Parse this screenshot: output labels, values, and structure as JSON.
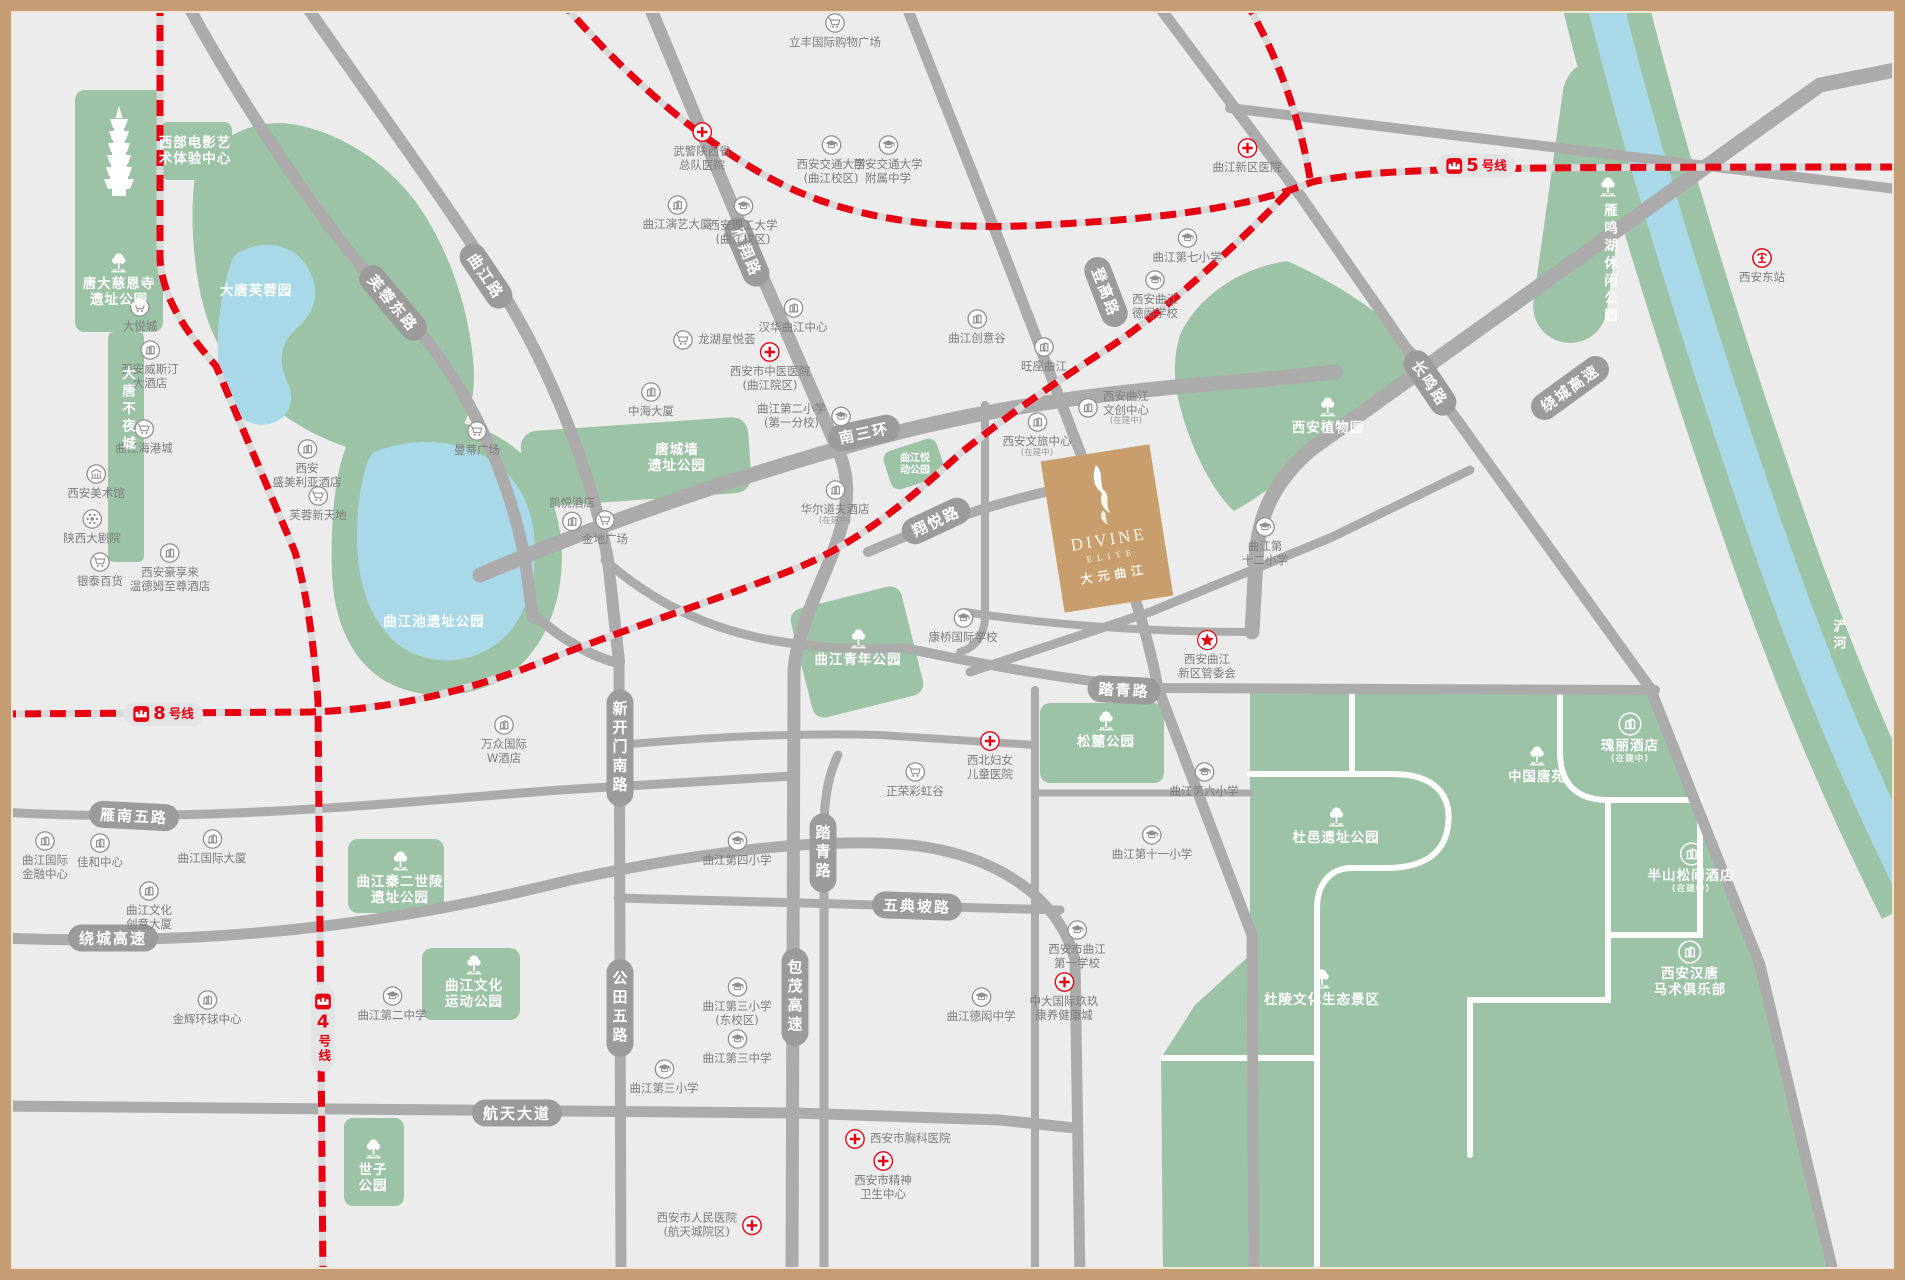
{
  "colors": {
    "metro_red": "#e60012",
    "road_gray": "#ababab",
    "road_pill": "#9b9b9b",
    "park_green": "#9dc3a6",
    "water_blue": "#a9d8e8",
    "brand_tan": "#c89e6c",
    "frame_tan": "#c59d72",
    "bg": "#ececec"
  },
  "divine": {
    "en": "DIVINE",
    "sub": "ELITE",
    "cn": "大元曲江"
  },
  "metro_badges": [
    {
      "n": "8",
      "s": "号线",
      "x": 163,
      "y": 714
    },
    {
      "n": "5",
      "s": "号线",
      "x": 1476,
      "y": 166
    },
    {
      "n": "4",
      "s": "号线",
      "x": 323,
      "y": 1028,
      "vt": 1
    }
  ],
  "road_labels": [
    {
      "t": "芙蓉东路",
      "x": 393,
      "y": 303,
      "r": 50
    },
    {
      "t": "曲江路",
      "x": 486,
      "y": 276,
      "r": 56
    },
    {
      "t": "雁翔路",
      "x": 747,
      "y": 252,
      "r": 67
    },
    {
      "t": "登高路",
      "x": 1106,
      "y": 292,
      "r": 69
    },
    {
      "t": "长鸣路",
      "x": 1430,
      "y": 383,
      "r": 56
    },
    {
      "t": "南三环",
      "x": 864,
      "y": 433,
      "r": -12
    },
    {
      "t": "绕城高速",
      "x": 1570,
      "y": 388,
      "r": -36
    },
    {
      "t": "绕城高速",
      "x": 113,
      "y": 938,
      "r": 0
    },
    {
      "t": "雁南五路",
      "x": 134,
      "y": 816,
      "r": 3
    },
    {
      "t": "航天大道",
      "x": 517,
      "y": 1113,
      "r": 0
    },
    {
      "t": "五典坡路",
      "x": 917,
      "y": 906,
      "r": 2
    },
    {
      "t": "踏青路",
      "x": 1124,
      "y": 690,
      "r": 3
    },
    {
      "t": "踏青路",
      "x": 823,
      "y": 853,
      "vt": 1
    },
    {
      "t": "新开门南路",
      "x": 620,
      "y": 748,
      "vt": 1
    },
    {
      "t": "公田五路",
      "x": 620,
      "y": 1008,
      "vt": 1
    },
    {
      "t": "包茂高速",
      "x": 795,
      "y": 997,
      "vt": 1
    },
    {
      "t": "翔悦路",
      "x": 936,
      "y": 521,
      "r": -25
    },
    {
      "t": "浐河",
      "x": 1838,
      "y": 636,
      "vt": 1,
      "plain": 1
    }
  ],
  "pois": [
    {
      "i": "cart",
      "x": 140,
      "y": 307,
      "l": [
        "大悦城"
      ]
    },
    {
      "i": "bldg",
      "x": 150,
      "y": 350,
      "l": [
        "西安威斯汀",
        "大酒店"
      ]
    },
    {
      "i": "cart",
      "x": 144,
      "y": 429,
      "l": [
        "曲江海港城"
      ]
    },
    {
      "i": "cart",
      "x": 477,
      "y": 431,
      "l": [
        "曼蒂广场"
      ]
    },
    {
      "i": "museum",
      "x": 96,
      "y": 474,
      "l": [
        "西安美术馆"
      ]
    },
    {
      "i": "theater",
      "x": 92,
      "y": 519,
      "l": [
        "陕西大剧院"
      ]
    },
    {
      "i": "cart",
      "x": 100,
      "y": 562,
      "l": [
        "银泰百货"
      ]
    },
    {
      "i": "bldg",
      "x": 170,
      "y": 553,
      "l": [
        "西安豪享来",
        "温德姆至尊酒店"
      ]
    },
    {
      "i": "bldg",
      "x": 307,
      "y": 449,
      "l": [
        "西安",
        "盛美利亚酒店"
      ]
    },
    {
      "i": "cart",
      "x": 318,
      "y": 496,
      "l": [
        "芙蓉新天地"
      ]
    },
    {
      "i": "bldg",
      "x": 572,
      "y": 521,
      "l": [
        "凯悦酒店"
      ],
      "lay": "lt"
    },
    {
      "i": "cart",
      "x": 605,
      "y": 520,
      "l": [
        "金地广场"
      ]
    },
    {
      "i": "bldg",
      "x": 504,
      "y": 725,
      "l": [
        "万众国际",
        "W酒店"
      ]
    },
    {
      "i": "cart",
      "x": 835,
      "y": 23,
      "l": [
        "立丰国际购物广场"
      ]
    },
    {
      "i": "hosp",
      "x": 702,
      "y": 132,
      "l": [
        "武警陕西省",
        "总队医院"
      ]
    },
    {
      "i": "school",
      "x": 831,
      "y": 145,
      "l": [
        "西安交通大学",
        "(曲江校区)"
      ]
    },
    {
      "i": "school",
      "x": 888,
      "y": 145,
      "l": [
        "西安交通大学",
        "附属中学"
      ]
    },
    {
      "i": "bldg",
      "x": 677,
      "y": 205,
      "l": [
        "曲江演艺大厦"
      ]
    },
    {
      "i": "school",
      "x": 743,
      "y": 206,
      "l": [
        "西安理工大学",
        "(曲江校区)"
      ]
    },
    {
      "i": "bldg",
      "x": 793,
      "y": 308,
      "l": [
        "汉华曲江中心"
      ]
    },
    {
      "i": "cart",
      "x": 683,
      "y": 340,
      "l": [
        "龙湖星悦荟"
      ],
      "lay": "hr"
    },
    {
      "i": "hosp",
      "x": 770,
      "y": 352,
      "l": [
        "西安市中医医院",
        "(曲江院区)"
      ]
    },
    {
      "i": "bldg",
      "x": 651,
      "y": 392,
      "l": [
        "中海大厦"
      ]
    },
    {
      "i": "school",
      "x": 841,
      "y": 416,
      "l": [
        "曲江第二小学",
        "(第一分校)"
      ],
      "lay": "hl"
    },
    {
      "i": "bldg",
      "x": 977,
      "y": 319,
      "l": [
        "曲江创意谷"
      ]
    },
    {
      "i": "bldg",
      "x": 1044,
      "y": 347,
      "l": [
        "旺座曲江"
      ]
    },
    {
      "i": "hosp",
      "x": 1247,
      "y": 148,
      "l": [
        "曲江新区医院"
      ]
    },
    {
      "i": "school",
      "x": 1187,
      "y": 238,
      "l": [
        "曲江第七小学"
      ]
    },
    {
      "i": "school",
      "x": 1155,
      "y": 280,
      "l": [
        "西安曲江",
        "德闳学校"
      ]
    },
    {
      "i": "bldg",
      "x": 1088,
      "y": 408,
      "l": [
        "西安曲江",
        "文创中心"
      ],
      "s": "(在建中)",
      "lay": "hr"
    },
    {
      "i": "bldg",
      "x": 1037,
      "y": 422,
      "l": [
        "西安文旅中心"
      ],
      "s": "(在建中)"
    },
    {
      "i": "bldg",
      "x": 835,
      "y": 490,
      "l": [
        "华尔道夫酒店"
      ],
      "s": "(在建中)"
    },
    {
      "i": "school",
      "x": 963,
      "y": 618,
      "l": [
        "康桥国际学校"
      ]
    },
    {
      "i": "star",
      "x": 1207,
      "y": 640,
      "l": [
        "西安曲江",
        "新区管委会"
      ]
    },
    {
      "i": "school",
      "x": 1265,
      "y": 527,
      "l": [
        "曲江第",
        "十二小学"
      ]
    },
    {
      "i": "train",
      "x": 1762,
      "y": 258,
      "l": [
        "西安东站"
      ]
    },
    {
      "i": "hosp",
      "x": 990,
      "y": 741,
      "l": [
        "西北妇女",
        "儿童医院"
      ]
    },
    {
      "i": "cart",
      "x": 915,
      "y": 772,
      "l": [
        "正荣彩虹谷"
      ]
    },
    {
      "i": "school",
      "x": 737,
      "y": 841,
      "l": [
        "曲江第四小学"
      ]
    },
    {
      "i": "school",
      "x": 1204,
      "y": 772,
      "l": [
        "曲江第六小学"
      ]
    },
    {
      "i": "school",
      "x": 1152,
      "y": 835,
      "l": [
        "曲江第十一小学"
      ]
    },
    {
      "i": "school",
      "x": 1077,
      "y": 930,
      "l": [
        "西安市曲江",
        "第一学校"
      ]
    },
    {
      "i": "hosp",
      "x": 1064,
      "y": 982,
      "l": [
        "中大国际玖玖",
        "康养健康城"
      ]
    },
    {
      "i": "school",
      "x": 981,
      "y": 997,
      "l": [
        "曲江德闳中学"
      ]
    },
    {
      "i": "school",
      "x": 737,
      "y": 987,
      "l": [
        "曲江第三小学",
        "(东校区)"
      ]
    },
    {
      "i": "school",
      "x": 737,
      "y": 1039,
      "l": [
        "曲江第三中学"
      ]
    },
    {
      "i": "school",
      "x": 664,
      "y": 1069,
      "l": [
        "曲江第三小学"
      ]
    },
    {
      "i": "school",
      "x": 392,
      "y": 996,
      "l": [
        "曲江第二中学"
      ]
    },
    {
      "i": "bldg",
      "x": 45,
      "y": 841,
      "l": [
        "曲江国际",
        "金融中心"
      ]
    },
    {
      "i": "bldg",
      "x": 100,
      "y": 843,
      "l": [
        "佳和中心"
      ]
    },
    {
      "i": "bldg",
      "x": 212,
      "y": 839,
      "l": [
        "曲江国际大厦"
      ]
    },
    {
      "i": "bldg",
      "x": 149,
      "y": 891,
      "l": [
        "曲江文化",
        "创意大厦"
      ]
    },
    {
      "i": "bldg",
      "x": 207,
      "y": 1000,
      "l": [
        "金辉环球中心"
      ]
    },
    {
      "i": "hosp",
      "x": 855,
      "y": 1139,
      "l": [
        "西安市胸科医院"
      ],
      "lay": "hr"
    },
    {
      "i": "hosp",
      "x": 883,
      "y": 1161,
      "l": [
        "西安市精神",
        "卫生中心"
      ]
    },
    {
      "i": "hosp",
      "x": 752,
      "y": 1225,
      "l": [
        "西安市人民医院",
        "(航天城院区)"
      ],
      "lay": "hl"
    },
    {
      "i": "bldg",
      "x": 1630,
      "y": 722,
      "l": [
        "瑰丽酒店"
      ],
      "s": "(在建中)",
      "w": 1
    },
    {
      "i": "bldg",
      "x": 1691,
      "y": 852,
      "l": [
        "半山松间酒店"
      ],
      "s": "(在建中)",
      "w": 1
    },
    {
      "i": "bldg",
      "x": 1690,
      "y": 950,
      "l": [
        "西安汉唐",
        "马术俱乐部"
      ],
      "w": 1
    },
    {
      "i": "tree",
      "x": 1537,
      "y": 753,
      "l": [
        "中国唐苑"
      ],
      "w": 1
    },
    {
      "i": "tree",
      "x": 1336,
      "y": 814,
      "l": [
        "杜邑遗址公园"
      ],
      "w": 1
    },
    {
      "i": "tree",
      "x": 1322,
      "y": 976,
      "l": [
        "杜陵文化生态景区"
      ],
      "w": 1
    },
    {
      "i": "tree",
      "x": 1608,
      "y": 184,
      "l": [
        "雁鸣湖休闲公园"
      ],
      "w": 1,
      "v": 1
    },
    {
      "i": "tree",
      "x": 1328,
      "y": 404,
      "l": [
        "西安植物园"
      ],
      "w": 1
    },
    {
      "i": "tree",
      "x": 1106,
      "y": 718,
      "l": [
        "松麓公园"
      ],
      "w": 1
    },
    {
      "i": "tree",
      "x": 858,
      "y": 636,
      "l": [
        "曲江青年公园"
      ],
      "w": 1
    },
    {
      "i": "tree",
      "x": 474,
      "y": 962,
      "l": [
        "曲江文化",
        "运动公园"
      ],
      "w": 1
    },
    {
      "i": "tree",
      "x": 400,
      "y": 858,
      "l": [
        "曲江秦二世陵",
        "遗址公园"
      ],
      "w": 1
    },
    {
      "i": "tree",
      "x": 373,
      "y": 1146,
      "l": [
        "世子",
        "公园"
      ],
      "w": 1
    },
    {
      "i": "tree",
      "x": 119,
      "y": 260,
      "l": [
        "唐大慈恩寺",
        "遗址公园"
      ],
      "w": 1
    },
    {
      "i": "",
      "x": 256,
      "y": 291,
      "l": [
        "大唐芙蓉园"
      ],
      "w": 1
    },
    {
      "i": "",
      "x": 434,
      "y": 622,
      "l": [
        "曲江池遗址公园"
      ],
      "w": 1
    },
    {
      "i": "",
      "x": 677,
      "y": 458,
      "l": [
        "唐城墙",
        "遗址公园"
      ],
      "w": 1
    },
    {
      "i": "",
      "x": 195,
      "y": 151,
      "l": [
        "西部电影艺",
        "术体验中心"
      ],
      "w": 1
    },
    {
      "i": "",
      "x": 126,
      "y": 408,
      "l": [
        "大唐不夜城"
      ],
      "w": 1,
      "v": 1
    },
    {
      "i": "",
      "x": 915,
      "y": 464,
      "l": [
        "曲江悦",
        "动公园"
      ],
      "w": 1,
      "sm": 1
    }
  ]
}
